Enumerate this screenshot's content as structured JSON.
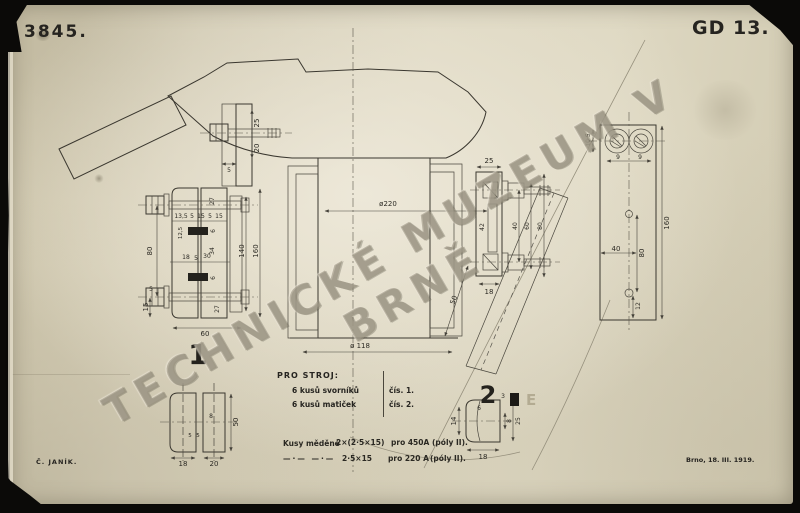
{
  "meta": {
    "paper_color": "#d9d2bb",
    "ink_color": "#2e2b26",
    "watermark_color": "#938c79"
  },
  "header": {
    "drawing_number": "3845.",
    "plate_code": "GD 13."
  },
  "watermark": {
    "text": "TECHNICKÉ MUZEUM V BRNĚ"
  },
  "footer": {
    "signature": "Č. JANÍK.",
    "date": "Brno, 18. III. 1919."
  },
  "parts_table": {
    "title": "PRO STROJ:",
    "rows": [
      {
        "qty": "6 kusů svorníků",
        "ref": "čís. 1."
      },
      {
        "qty": "6 kusů matiček",
        "ref": "čís. 2."
      }
    ]
  },
  "material_notes": {
    "label": "Kusy měděné",
    "ditto": "—·—  —·—",
    "rows": [
      {
        "dim": "2×(2·5×15)",
        "for": "pro 450A",
        "poles": "(póly II)."
      },
      {
        "dim": "2·5×15",
        "for": "pro 220 A",
        "poles": "(póly II)."
      }
    ]
  },
  "part_labels": {
    "part1": "1",
    "part2": "2",
    "stamp_e": "E"
  },
  "dims": {
    "d3": "3",
    "d5": "5",
    "d6": "6",
    "d8": "8",
    "d9": "9",
    "d12": "12",
    "d14": "14",
    "d15": "15",
    "d18": "18",
    "d20": "20",
    "d25": "25",
    "d27": "27",
    "d30": "30",
    "d34": "34",
    "d40": "40",
    "d42": "42",
    "d50": "50",
    "d60": "60",
    "d80": "80",
    "d105": "10·5",
    "d125": "12,5",
    "d135": "13,5",
    "d140": "140",
    "d160": "160",
    "dia220": "ø220",
    "dia118": "ø 118"
  }
}
